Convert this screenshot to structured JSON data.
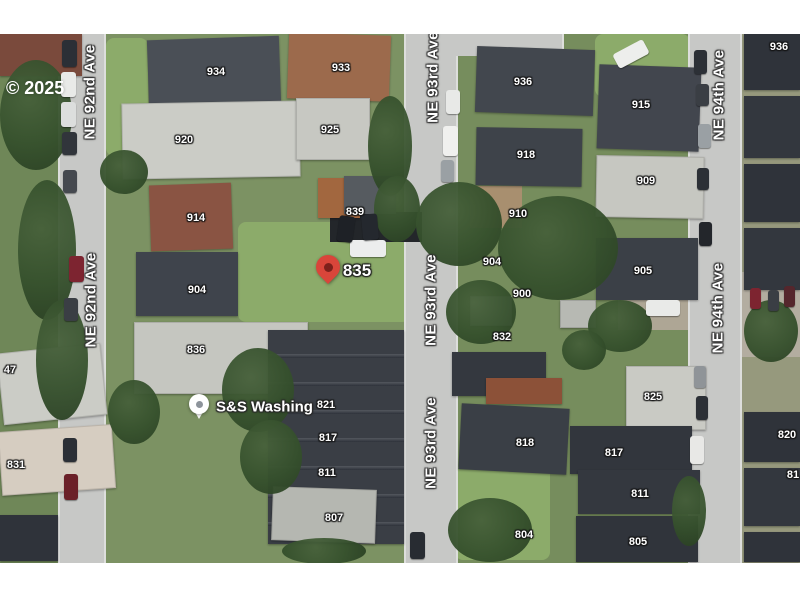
{
  "watermark": "© 2025",
  "map": {
    "streets": [
      {
        "name": "NE 92nd Ave",
        "x": 90,
        "y": 92
      },
      {
        "name": "NE 92nd Ave",
        "x": 91,
        "y": 300
      },
      {
        "name": "NE 93rd Ave",
        "x": 433,
        "y": 77
      },
      {
        "name": "NE 93rd Ave",
        "x": 431,
        "y": 300
      },
      {
        "name": "NE 93rd Ave",
        "x": 431,
        "y": 443
      },
      {
        "name": "NE 94th Ave",
        "x": 719,
        "y": 95
      },
      {
        "name": "NE 94th Ave",
        "x": 718,
        "y": 308
      }
    ],
    "house_numbers": [
      {
        "label": "934",
        "x": 216,
        "y": 72
      },
      {
        "label": "933",
        "x": 341,
        "y": 68
      },
      {
        "label": "920",
        "x": 184,
        "y": 140
      },
      {
        "label": "925",
        "x": 330,
        "y": 130
      },
      {
        "label": "936",
        "x": 523,
        "y": 82
      },
      {
        "label": "918",
        "x": 526,
        "y": 155
      },
      {
        "label": "915",
        "x": 641,
        "y": 105
      },
      {
        "label": "936",
        "x": 779,
        "y": 47
      },
      {
        "label": "909",
        "x": 646,
        "y": 181
      },
      {
        "label": "914",
        "x": 196,
        "y": 218
      },
      {
        "label": "839",
        "x": 355,
        "y": 212
      },
      {
        "label": "910",
        "x": 518,
        "y": 214
      },
      {
        "label": "904",
        "x": 197,
        "y": 290
      },
      {
        "label": "904",
        "x": 492,
        "y": 262
      },
      {
        "label": "900",
        "x": 522,
        "y": 294
      },
      {
        "label": "905",
        "x": 643,
        "y": 271
      },
      {
        "label": "832",
        "x": 502,
        "y": 337
      },
      {
        "label": "836",
        "x": 196,
        "y": 350
      },
      {
        "label": "825",
        "x": 653,
        "y": 397
      },
      {
        "label": "821",
        "x": 326,
        "y": 405
      },
      {
        "label": "817",
        "x": 328,
        "y": 438
      },
      {
        "label": "811",
        "x": 327,
        "y": 473
      },
      {
        "label": "807",
        "x": 334,
        "y": 518
      },
      {
        "label": "818",
        "x": 525,
        "y": 443
      },
      {
        "label": "817",
        "x": 614,
        "y": 453
      },
      {
        "label": "811",
        "x": 640,
        "y": 494
      },
      {
        "label": "804",
        "x": 524,
        "y": 535
      },
      {
        "label": "805",
        "x": 638,
        "y": 542
      },
      {
        "label": "820",
        "x": 787,
        "y": 435
      },
      {
        "label": "831",
        "x": 16,
        "y": 465
      },
      {
        "label": "47",
        "x": 10,
        "y": 370
      },
      {
        "label": "81",
        "x": 793,
        "y": 475
      }
    ],
    "pin": {
      "label": "835",
      "x": 328,
      "y": 291,
      "label_x": 357,
      "label_y": 271
    },
    "poi": {
      "label": "S&S Washing",
      "x": 199,
      "y": 407,
      "label_x": 216,
      "label_y": 407
    }
  },
  "colors": {
    "pin_red": "#d9453a",
    "pin_inner": "#7d201b",
    "road": "#c7c8c6",
    "grass": "#7c9263"
  }
}
